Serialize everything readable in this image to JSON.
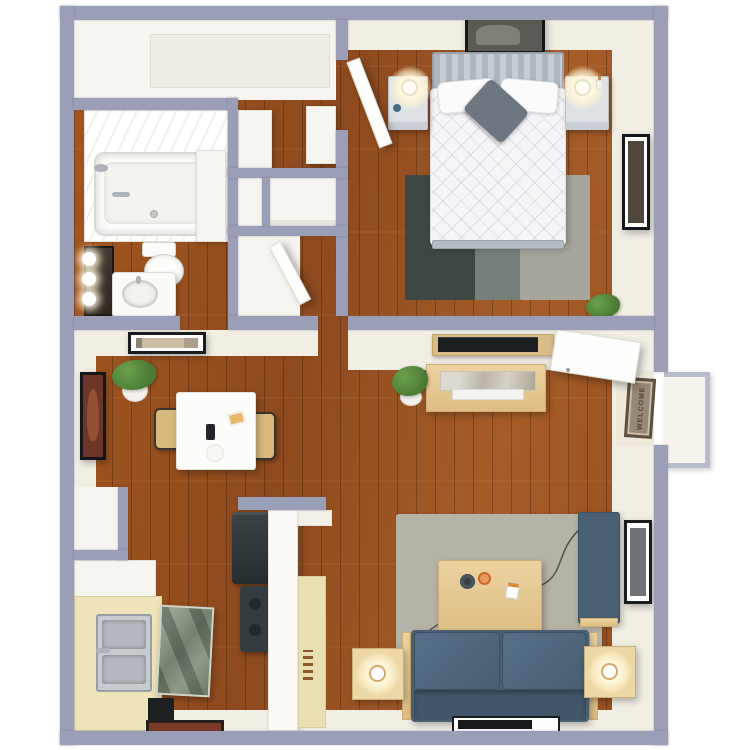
{
  "meta": {
    "label": "3D top-down floor plan render of a one-bedroom, one-bathroom apartment with wood floors",
    "type": "3d-floor-plan",
    "background": "#ffffff"
  },
  "palette": {
    "exterior_wall": "#9a9eb6",
    "interior_wall_face": "#f2eee4",
    "white_room": "#f7f5ef",
    "floor_wood": "#9d5222",
    "floor_wood_highlight": "#a65d28",
    "sofa_blue": "#4a5f71",
    "bench_blue": "#4a5f71",
    "living_rug_gray": "#b7b2a7",
    "bedroom_rug_dark": "#3d4843",
    "bedroom_rug_mid": "#76807a",
    "bedroom_rug_light": "#a6a69d",
    "light_wood_furniture": "#e3c893",
    "counter_tan": "#efe3b9",
    "appliance_dark": "#2f373b",
    "stainless_steel": "#c6cbd0",
    "dishwasher_glass": "#8b9885",
    "doormat_brown": "#978977",
    "art_maroon": "#6d3627",
    "lamp_glow": "#fff3cf",
    "plant_green": "#538a3c",
    "bed_duvet": "#f5f5f7",
    "headboard_gray": "#b4bcc4"
  },
  "rooms": [
    {
      "id": "bedroom",
      "name": "Bedroom",
      "position": "top-right"
    },
    {
      "id": "bathroom",
      "name": "Bathroom",
      "position": "top-left"
    },
    {
      "id": "closets",
      "name": "Hall closets and cubbies",
      "position": "top-center"
    },
    {
      "id": "entry-closet",
      "name": "Entry closet strip",
      "position": "top-left-strip"
    },
    {
      "id": "dining",
      "name": "Dining area",
      "position": "middle-left"
    },
    {
      "id": "kitchen",
      "name": "Galley kitchen",
      "position": "bottom-left"
    },
    {
      "id": "living",
      "name": "Living room",
      "position": "bottom-right"
    },
    {
      "id": "entry",
      "name": "Entry with front door and exterior stoop",
      "position": "middle-right"
    }
  ],
  "furniture": {
    "bedroom": [
      "queen bed with white quilted duvet",
      "gray slatted headboard",
      "two white pillows",
      "gray throw pillow",
      "framed art above bed",
      "framed portrait on right wall",
      "left nightstand with lamp and blue ornament",
      "right nightstand with lamp and vase",
      "three-tone area rug",
      "open bedroom door",
      "potted plant"
    ],
    "bathroom": [
      "bathtub with shower head",
      "tub partition",
      "toilet",
      "vanity mirror with three lights",
      "sink cabinet with round basin"
    ],
    "closets": [
      "hall closet with white shelf units",
      "two linen cubbies",
      "lower closet with open door"
    ],
    "dining": [
      "white square dining table",
      "two bentwood chairs",
      "phone on table",
      "notecard on table",
      "white bowl",
      "potted plant",
      "maroon framed art on left wall",
      "horizontal framed art on wall"
    ],
    "kitchen": [
      "white upper cabinets",
      "tan countertop run",
      "double stainless sink",
      "open dishwasher with glass panel",
      "dark base cabinet",
      "refrigerator",
      "range stove",
      "partition wall with gray cap",
      "tan pantry cabinet",
      "kitchen floor mat",
      "utility closet"
    ],
    "living": [
      "wall-mounted TV in wood niche",
      "light wood media console with marble tray",
      "potted plant",
      "gray area rug",
      "wood coffee table with two mugs and card",
      "blue two-cushion sofa with wood rails",
      "blue accent bench",
      "left side table with lamp",
      "right side table with lamp",
      "framed art on right wall",
      "dark framed mat below sofa"
    ],
    "entry": [
      "open front door",
      "welcome doormat",
      "exterior concrete stoop"
    ]
  },
  "entry": {
    "doormat_text": "WELCOME"
  }
}
